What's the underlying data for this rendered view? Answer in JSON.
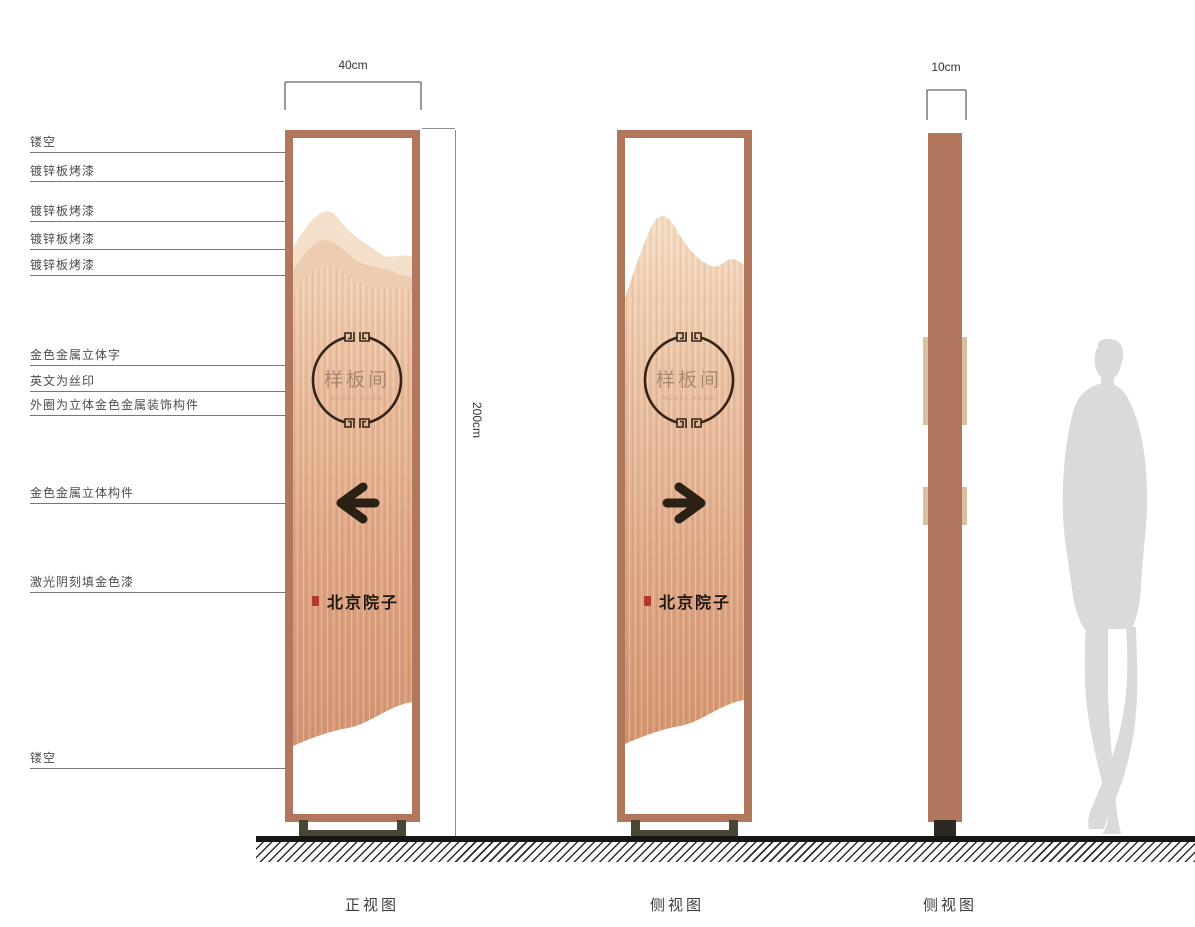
{
  "annotations": [
    {
      "text": "镂空"
    },
    {
      "text": "镀锌板烤漆"
    },
    {
      "text": "镀锌板烤漆"
    },
    {
      "text": "镀锌板烤漆"
    },
    {
      "text": "镀锌板烤漆"
    },
    {
      "text": "金色金属立体字"
    },
    {
      "text": "英文为丝印"
    },
    {
      "text": "外圈为立体金色金属装饰构件"
    },
    {
      "text": "金色金属立体构件"
    },
    {
      "text": "激光阴刻填金色漆"
    },
    {
      "text": "镂空"
    }
  ],
  "dimensions": {
    "front_width": "40cm",
    "side_width": "10cm",
    "height": "200cm"
  },
  "captions": {
    "front_view": "正视图",
    "side_view_1": "侧视图",
    "side_view_2": "侧视图"
  },
  "sign": {
    "room_name": "样板间",
    "english_caption": "MODEL ROOM",
    "brand": "北京院子"
  },
  "colors": {
    "frame_copper": "#b2765c",
    "panel_copper": "#d49a7b",
    "mountain_light": "#f4dfca",
    "mountain_mid": "#eccdaf",
    "detail_dark": "#2e2216",
    "seal_red": "#b23a2a",
    "tan_protrusion": "#d9c0a2",
    "base_olive": "#4a4636",
    "silhouette_gray": "#dadada"
  }
}
